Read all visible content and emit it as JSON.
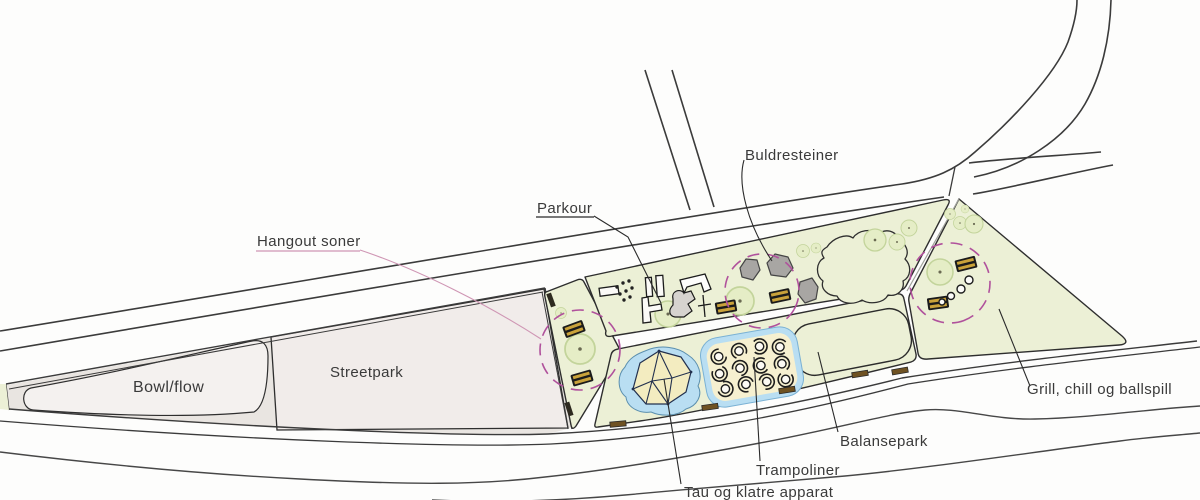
{
  "plan": {
    "labels": {
      "bowl_flow": "Bowl/flow",
      "streetpark": "Streetpark",
      "hangout_soner": "Hangout soner",
      "parkour": "Parkour",
      "buldresteiner": "Buldresteiner",
      "tau_og_klatre": "Tau og klatre apparat",
      "trampoliner": "Trampoliner",
      "balansepark": "Balansepark",
      "grill": "Grill, chill og ballspill"
    },
    "colors": {
      "park_green": "#ecf0d6",
      "tree_green": "#e5edc6",
      "hangout_dash_pink": "#b0519c",
      "label_pink": "#cf96b4",
      "water_blue": "#b9def2",
      "sand_yellow": "#f3ecc0",
      "trampoline_cream": "#f6f0d0",
      "bench_stripe_gold": "#c9a23a",
      "boulder_gray": "#a8a6a3",
      "surface_gray": "#efecea",
      "line_dark": "#3b3b3b"
    },
    "symbols": [
      {
        "name": "tree-icon"
      },
      {
        "name": "bench-icon"
      },
      {
        "name": "boulder-icon"
      },
      {
        "name": "trampoline-icon"
      },
      {
        "name": "hangout-circle-icon"
      },
      {
        "name": "climbing-structure-icon"
      },
      {
        "name": "parkour-obstacle-icon"
      }
    ]
  }
}
